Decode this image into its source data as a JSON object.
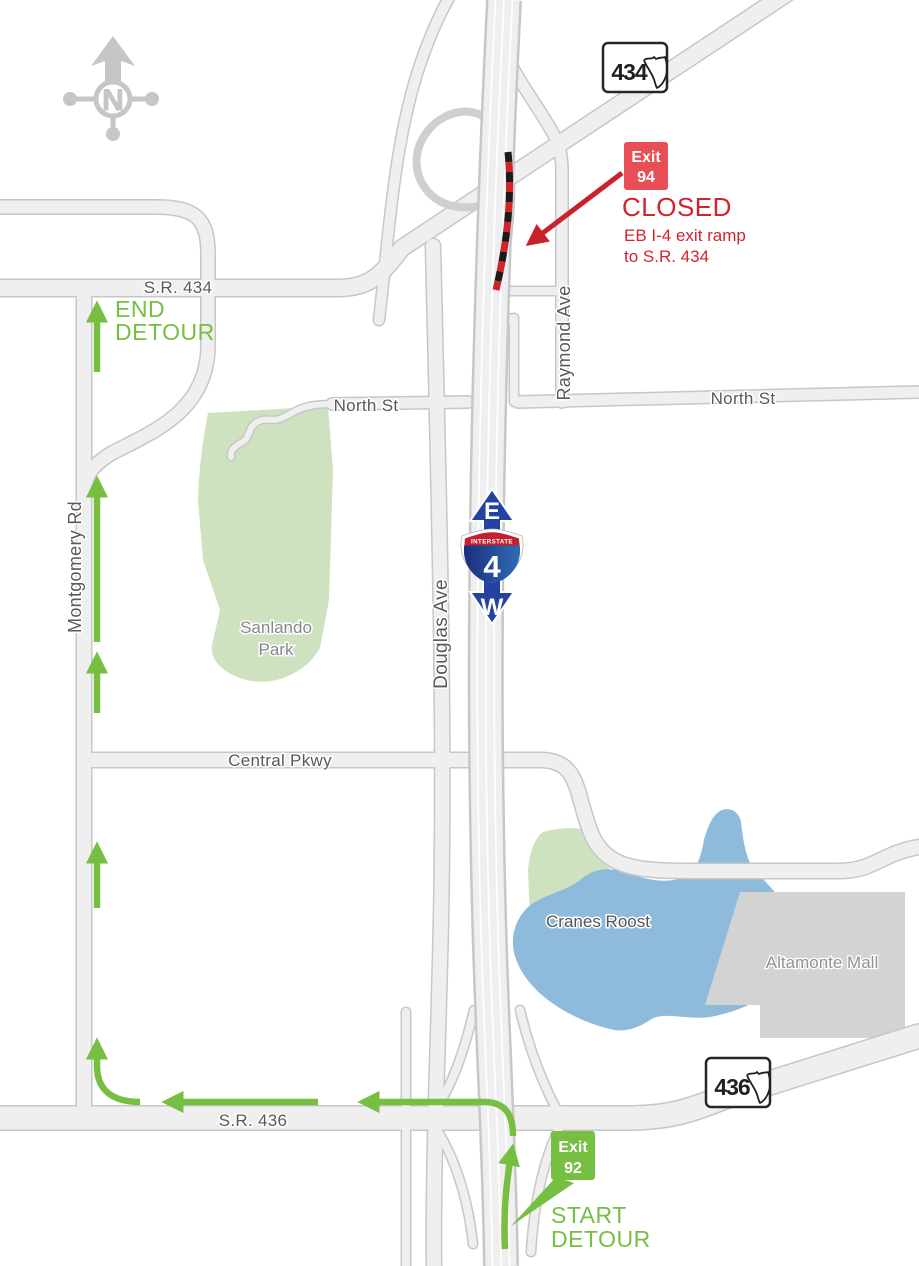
{
  "compass": {
    "north": "N"
  },
  "closure": {
    "badge_top": "Exit",
    "badge_num": "94",
    "status": "CLOSED",
    "detail1": "EB I-4 exit ramp",
    "detail2": "to S.R. 434"
  },
  "detour": {
    "start_badge_top": "Exit",
    "start_badge_num": "92",
    "start1": "START",
    "start2": "DETOUR",
    "end1": "END",
    "end2": "DETOUR"
  },
  "interstate": {
    "band": "INTERSTATE",
    "number": "4",
    "dir_east": "E",
    "dir_west": "W"
  },
  "shields": {
    "sr434": "434",
    "sr436": "436"
  },
  "roads": {
    "sr434": "S.R. 434",
    "sr436": "S.R. 436",
    "north_st_w": "North St",
    "north_st_e": "North St",
    "raymond": "Raymond Ave",
    "montgomery": "Montgomery Rd",
    "douglas": "Douglas Ave",
    "central": "Central Pkwy"
  },
  "places": {
    "sanlando1": "Sanlando",
    "sanlando2": "Park",
    "cranes": "Cranes Roost",
    "mall": "Altamonte Mall"
  },
  "colors": {
    "detour_green": "#76bf43",
    "closure_red": "#d3232d",
    "exit94_box_red": "#e84e55",
    "road_fill": "#efefef",
    "road_casing": "#c7c7c7",
    "park_green": "#cfe2c0",
    "lake_blue": "#8ebbdb",
    "mall_gray": "#d3d3d3",
    "interstate_red": "#c3202f",
    "interstate_blue": "#1b2d7d",
    "direction_arrow_blue": "#2443a0",
    "compass_gray": "#c6c6c6",
    "street_label_gray": "#58595b"
  }
}
